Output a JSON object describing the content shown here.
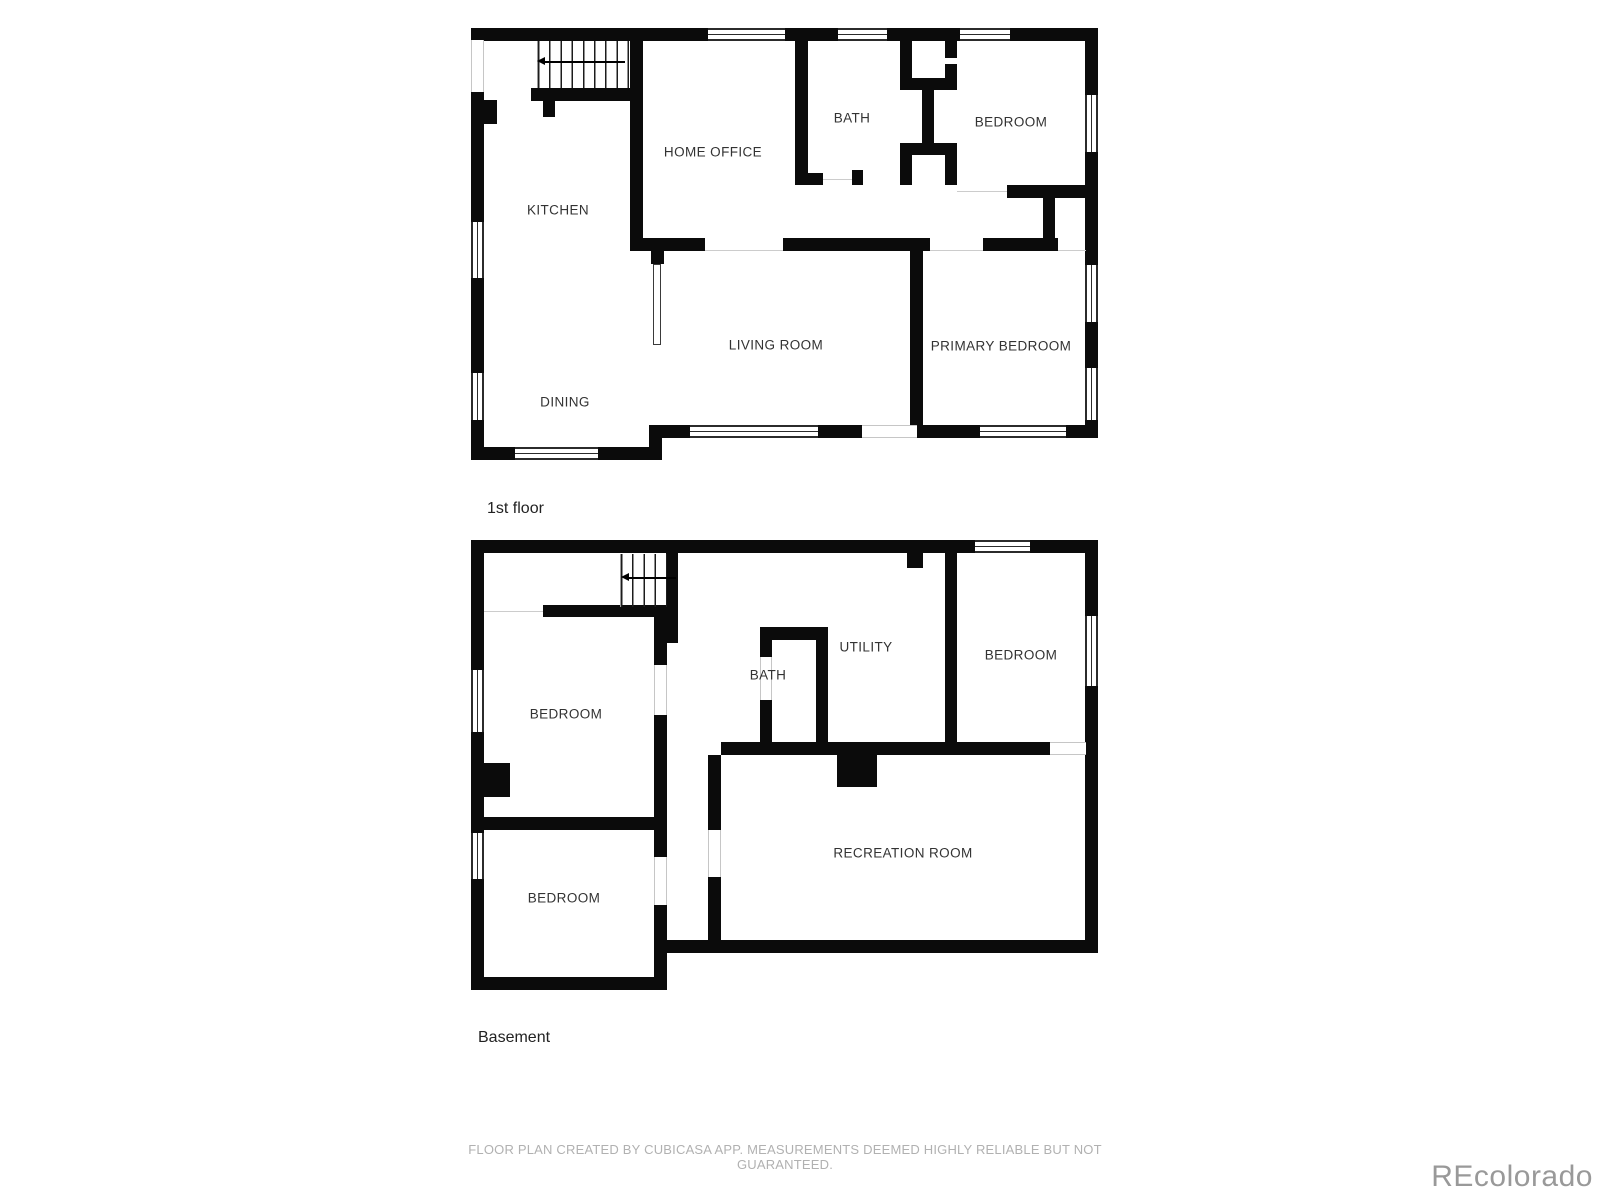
{
  "page": {
    "background": "#ffffff"
  },
  "colors": {
    "wall": "#0b0b0b",
    "room_label": "#333333",
    "floor_label": "#222222",
    "footer_text": "#b1b1b1",
    "watermark": "#999999"
  },
  "floors": [
    {
      "id": "first-floor",
      "label": "1st floor",
      "rooms": [
        {
          "name": "KITCHEN",
          "x": 558,
          "y": 210
        },
        {
          "name": "HOME OFFICE",
          "x": 713,
          "y": 152
        },
        {
          "name": "BATH",
          "x": 852,
          "y": 118
        },
        {
          "name": "BEDROOM",
          "x": 1011,
          "y": 122
        },
        {
          "name": "LIVING ROOM",
          "x": 776,
          "y": 345
        },
        {
          "name": "PRIMARY BEDROOM",
          "x": 1001,
          "y": 346
        },
        {
          "name": "DINING",
          "x": 565,
          "y": 402
        }
      ]
    },
    {
      "id": "basement",
      "label": "Basement",
      "rooms": [
        {
          "name": "BEDROOM",
          "x": 566,
          "y": 714
        },
        {
          "name": "BATH",
          "x": 768,
          "y": 675
        },
        {
          "name": "UTILITY",
          "x": 866,
          "y": 647
        },
        {
          "name": "BEDROOM",
          "x": 1021,
          "y": 655
        },
        {
          "name": "BEDROOM",
          "x": 564,
          "y": 898
        },
        {
          "name": "RECREATION ROOM",
          "x": 903,
          "y": 853
        }
      ]
    }
  ],
  "stairs": [
    {
      "floor": "first-floor",
      "direction": "left"
    },
    {
      "floor": "basement",
      "direction": "left"
    }
  ],
  "footer": {
    "text": "FLOOR PLAN CREATED BY CUBICASA APP. MEASUREMENTS DEEMED HIGHLY RELIABLE BUT NOT GUARANTEED."
  },
  "watermark": {
    "text": "REcolorado"
  }
}
